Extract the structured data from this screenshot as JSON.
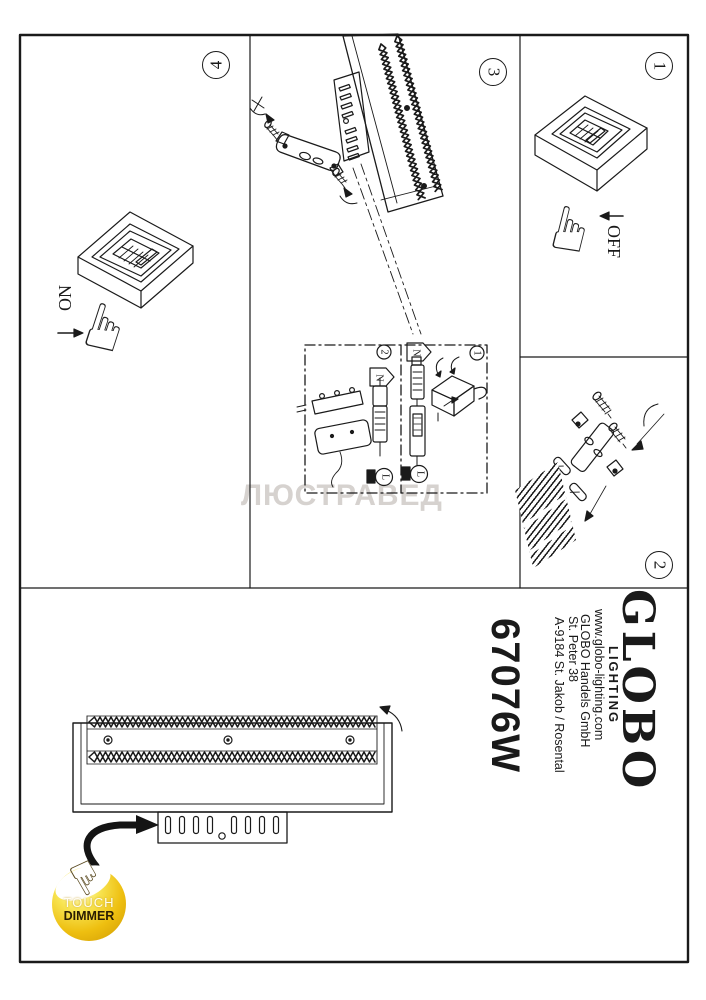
{
  "page": {
    "watermark": "ЛЮСТРАВЕД",
    "line_color": "#1a1a1a",
    "background": "#ffffff"
  },
  "steps": {
    "s1": "1",
    "s2": "2",
    "s3": "3",
    "s4": "4"
  },
  "panel1": {
    "switch_label": "OFF"
  },
  "panel4": {
    "switch_label": "ON"
  },
  "inset": {
    "tag_n": "N",
    "tag_l": "L",
    "sub1": "1",
    "sub2": "2"
  },
  "branding": {
    "logo": "GLOBO",
    "logo_sub": "LIGHTING",
    "website": "www.globo-lighting.com",
    "company": "GLOBO Handels GmbH",
    "street": "St. Peter 38",
    "city": "A-9184 St. Jakob / Rosental",
    "model": "67076W"
  },
  "badge": {
    "line1": "TOUCH",
    "line2": "DIMMER",
    "color_gold": "#eebf10",
    "color_light": "#fffbe0"
  },
  "icons": {
    "pointing_hand": "☝"
  }
}
